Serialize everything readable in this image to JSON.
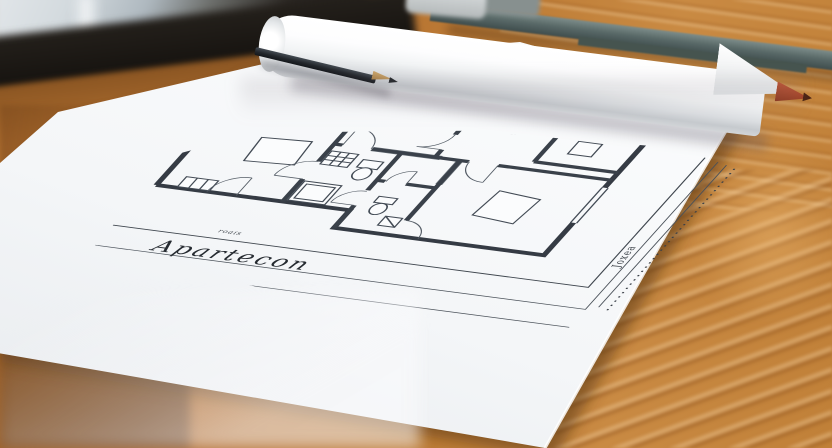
{
  "scene": {
    "setting": "architectural floor plan drawing lying on a wooden desk",
    "sheet": {
      "title": "Apartecon",
      "small_label": "roais",
      "side_label": "Joxea"
    },
    "objects": {
      "rolled_paper": "rolled-paper-tube",
      "graphite_pencil": "graphite-pencil",
      "red_pencil": "red-tip-pencil",
      "ruler": "straightedge-ruler",
      "eraser": "eraser",
      "desk": "wooden-desk",
      "window": "blurred-window"
    },
    "colors": {
      "wood_light": "#cf9049",
      "wood_mid": "#b06a2c",
      "wood_dark": "#7d4a1c",
      "paper": "#f7f8fa",
      "plan_line": "#353b44",
      "pencil_body": "#2e3338",
      "pencil_tip_red": "#a8402a",
      "ruler_gray": "#5d6e6e",
      "window_gray": "#cfd6db"
    }
  }
}
